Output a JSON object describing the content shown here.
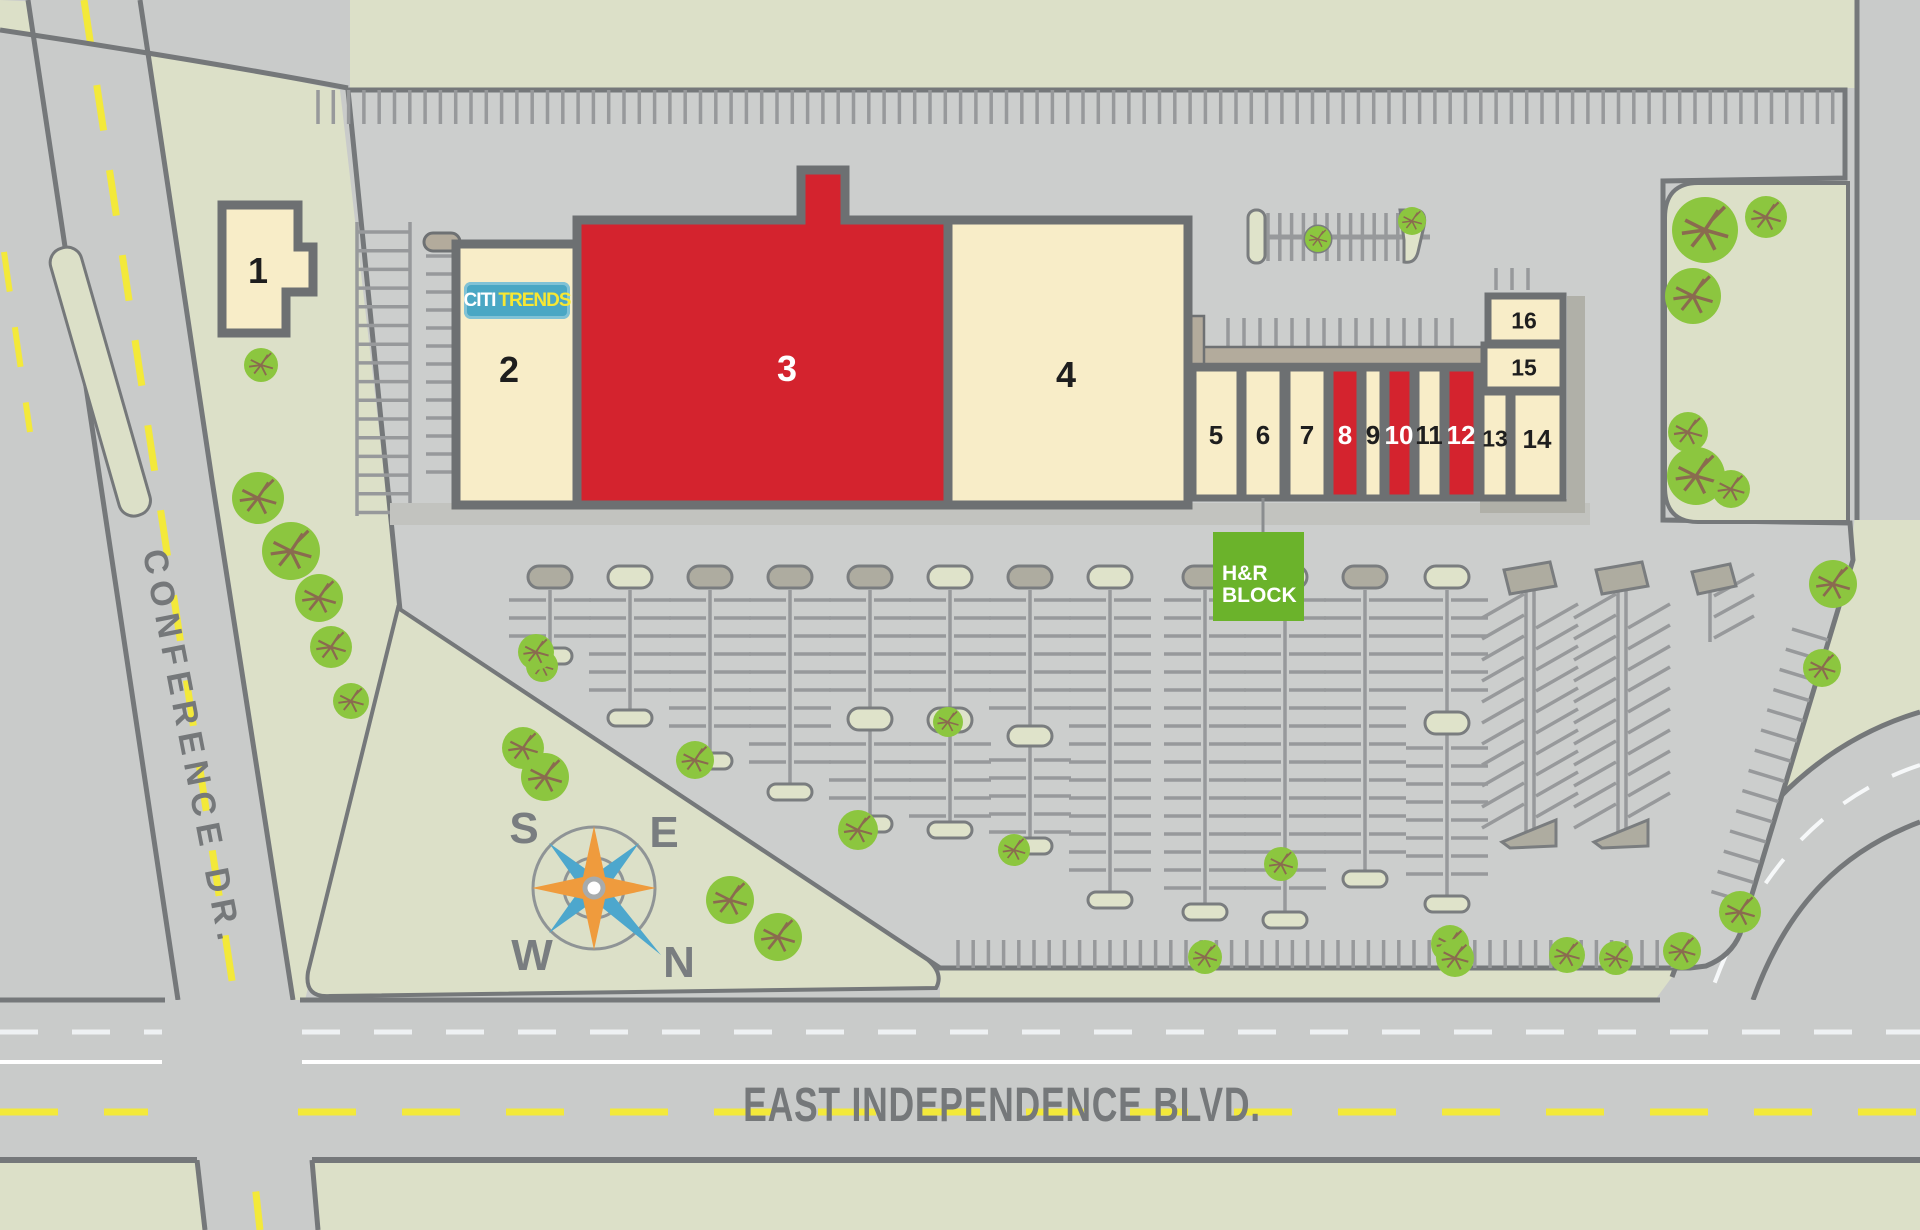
{
  "map": {
    "streets": {
      "conference": "CONFERENCE DR.",
      "independence": "EAST INDEPENDENCE BLVD."
    },
    "compass": {
      "north": "N",
      "south": "S",
      "east": "E",
      "west": "W"
    },
    "tenants": {
      "citi_trends": {
        "part1": "CITI",
        "part2": "TRENDS",
        "unit": "2"
      },
      "hr_block": {
        "line1": "H&R",
        "line2": "BLOCK",
        "unit": "6"
      }
    },
    "units": [
      {
        "label": "1",
        "variant": "available"
      },
      {
        "label": "2",
        "variant": "available"
      },
      {
        "label": "3",
        "variant": "leased"
      },
      {
        "label": "4",
        "variant": "available"
      },
      {
        "label": "5",
        "variant": "available"
      },
      {
        "label": "6",
        "variant": "available"
      },
      {
        "label": "7",
        "variant": "available"
      },
      {
        "label": "8",
        "variant": "leased"
      },
      {
        "label": "9",
        "variant": "available"
      },
      {
        "label": "10",
        "variant": "leased"
      },
      {
        "label": "11",
        "variant": "available"
      },
      {
        "label": "12",
        "variant": "leased"
      },
      {
        "label": "13",
        "variant": "available"
      },
      {
        "label": "14",
        "variant": "available"
      },
      {
        "label": "15",
        "variant": "available"
      },
      {
        "label": "16",
        "variant": "available"
      }
    ],
    "colors": {
      "available_fill": "#f8edc8",
      "leased_fill": "#d4232e",
      "grass": "#dce0c8",
      "pavement": "#cccecd",
      "road_border": "#75787a",
      "hr_block_green": "#6bb32b",
      "citi_trends_blue": "#4aa7c4",
      "centerline_yellow": "#f3e93a",
      "tree_green": "#8cc63f"
    }
  }
}
